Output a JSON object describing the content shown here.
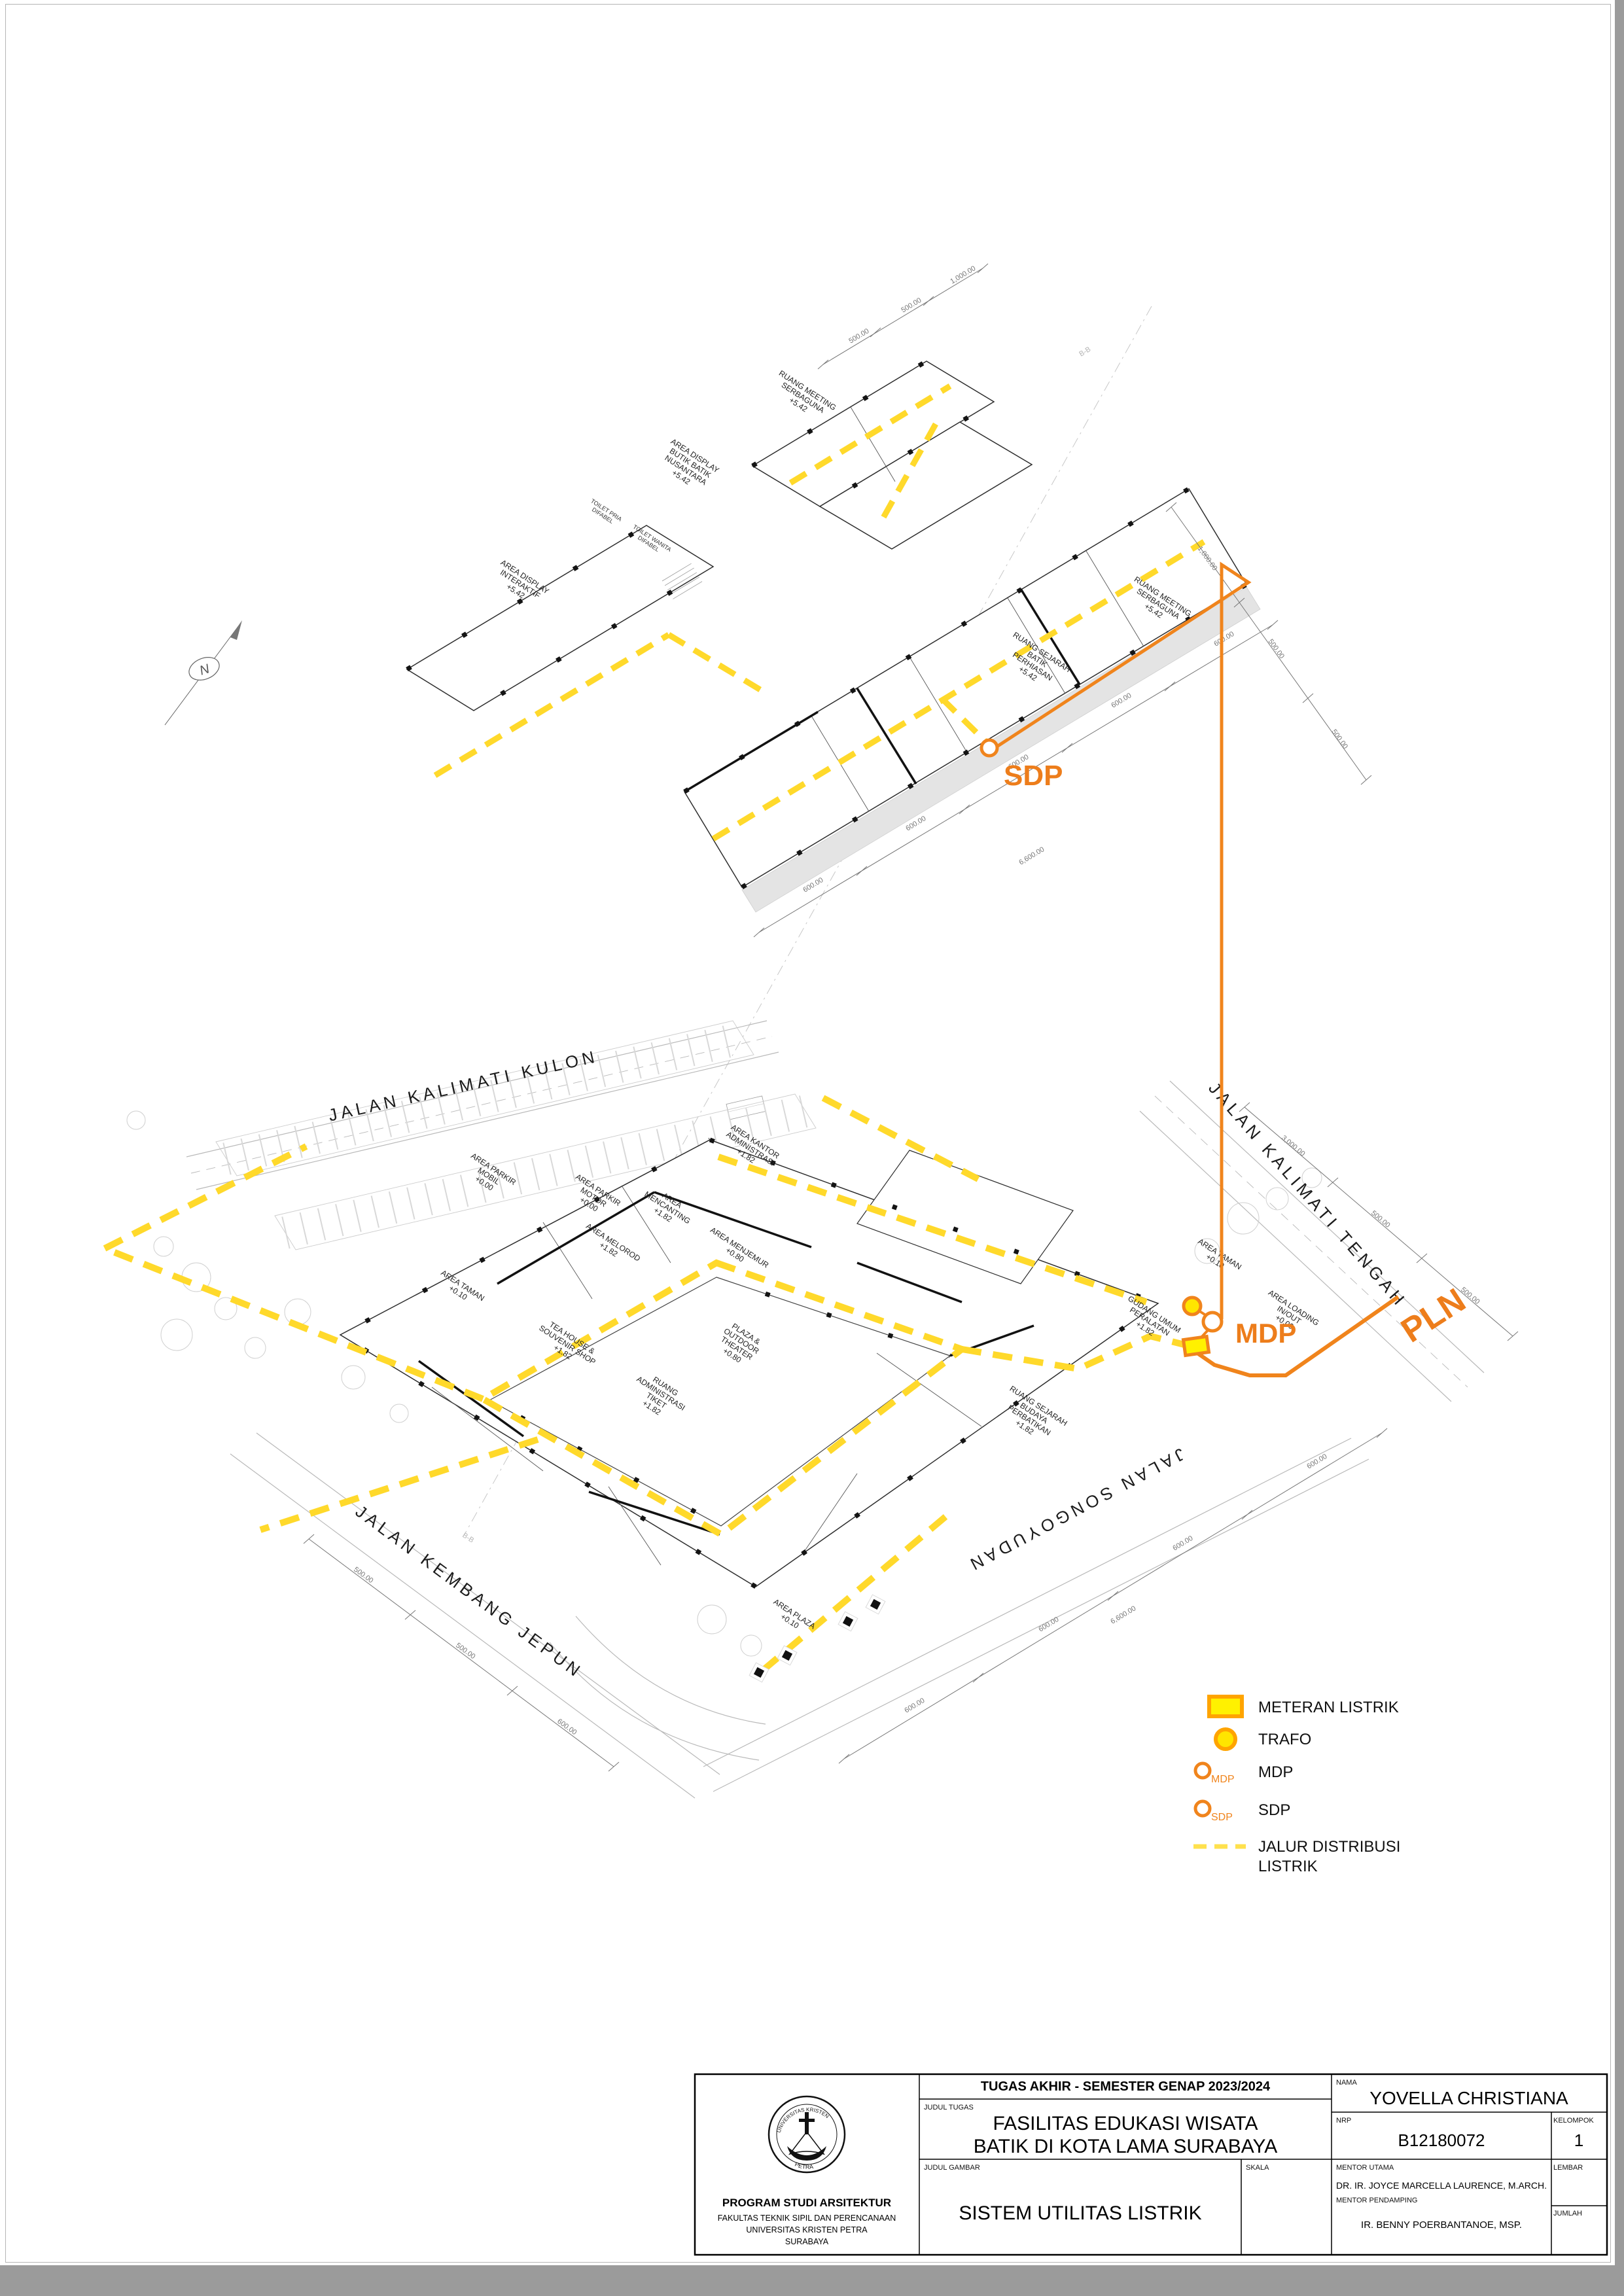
{
  "annotations": {
    "sdp": "SDP",
    "mdp": "MDP",
    "pln": "PLN",
    "north": "N",
    "section": "B-B"
  },
  "streets": {
    "kulon": "JALAN KALIMATI KULON",
    "tengah": "JALAN KALIMATI TENGAH",
    "jepun": "JALAN KEMBANG JEPUN",
    "songoyudan": "JALAN SONGOYUDAN"
  },
  "upper_rooms": [
    [
      "RUANG MEETING",
      "SERBAGUNA",
      "+5.42"
    ],
    [
      "AREA DISPLAY",
      "BUTIK BATIK",
      "NUSANTARA",
      "+5.42"
    ],
    [
      "AREA DISPLAY",
      "INTERAKTIF",
      "+5.42"
    ],
    [
      "RUANG MEETING",
      "SERBAGUNA",
      "+5.42"
    ],
    [
      "RUANG SEJARAH",
      "BATIK",
      "PERHIASAN",
      "+5.42"
    ],
    [
      "TOILET PRIA",
      "DIFABEL"
    ],
    [
      "TOILET WANITA",
      "DIFABEL"
    ]
  ],
  "lower_rooms": [
    [
      "AREA PARKIR",
      "MOBIL",
      "+0.00"
    ],
    [
      "AREA PARKIR",
      "MOTOR",
      "+0.00"
    ],
    [
      "AREA",
      "MENCANTING",
      "+1.82"
    ],
    [
      "AREA MELOROD",
      "+1.82"
    ],
    [
      "AREA MENJEMUR",
      "+0.80"
    ],
    [
      "AREA KANTOR",
      "ADMINISTRASI",
      "+1.82"
    ],
    [
      "TEA HOUSE &",
      "SOUVENIR SHOP",
      "+1.82"
    ],
    [
      "PLAZA &",
      "OUTDOOR",
      "THEATER",
      "+0.80"
    ],
    [
      "RUANG",
      "ADMINISTRASI",
      "TIKET",
      "+1.82"
    ],
    [
      "AREA TAMAN",
      "+0.10"
    ],
    [
      "AREA TAMAN",
      "+0.10"
    ],
    [
      "AREA PLAZA",
      "+0.10"
    ],
    [
      "AREA LOADING",
      "IN/OUT",
      "+0.00"
    ],
    [
      "GUDANG UMUM",
      "PERALATAN",
      "+1.82"
    ],
    [
      "RUANG SEJARAH",
      "BUDAYA",
      "PERBATIKAN",
      "+1.82"
    ]
  ],
  "dims": {
    "d500": "500.00",
    "d1000": "1,000.00",
    "d600": "600.00",
    "d6600": "6,600.00",
    "d3000": "3,000.00"
  },
  "legend": {
    "meteran": "METERAN LISTRIK",
    "trafo": "TRAFO",
    "mdp": "MDP",
    "sdp": "SDP",
    "mdp_tag": "MDP",
    "sdp_tag": "SDP",
    "jalur1": "JALUR DISTRIBUSI",
    "jalur2": "LISTRIK"
  },
  "titleblock": {
    "header": "TUGAS AKHIR - SEMESTER GENAP 2023/2024",
    "judul_tugas_label": "JUDUL TUGAS",
    "judul_tugas_1": "FASILITAS EDUKASI WISATA",
    "judul_tugas_2": "BATIK DI KOTA LAMA SURABAYA",
    "judul_gambar_label": "JUDUL GAMBAR",
    "judul_gambar": "SISTEM UTILITAS LISTRIK",
    "skala_label": "SKALA",
    "nama_label": "NAMA",
    "nama": "YOVELLA CHRISTIANA",
    "nrp_label": "NRP",
    "nrp": "B12180072",
    "kelompok_label": "KELOMPOK",
    "kelompok": "1",
    "mentor_utama_label": "MENTOR UTAMA",
    "mentor_utama": "DR. IR. JOYCE MARCELLA LAURENCE, M.ARCH.",
    "mentor_pendamping_label": "MENTOR PENDAMPING",
    "mentor_pendamping": "IR. BENNY POERBANTANOE, MSP.",
    "lembar_label": "LEMBAR",
    "jumlah_label": "JUMLAH",
    "prodi": "PROGRAM STUDI ARSITEKTUR",
    "fakultas": "FAKULTAS TEKNIK SIPIL DAN PERENCANAAN",
    "univ": "UNIVERSITAS KRISTEN PETRA",
    "kota": "SURABAYA"
  },
  "logo": {
    "top": "UNIVERSITAS KRISTEN",
    "bottom": "PETRA"
  }
}
